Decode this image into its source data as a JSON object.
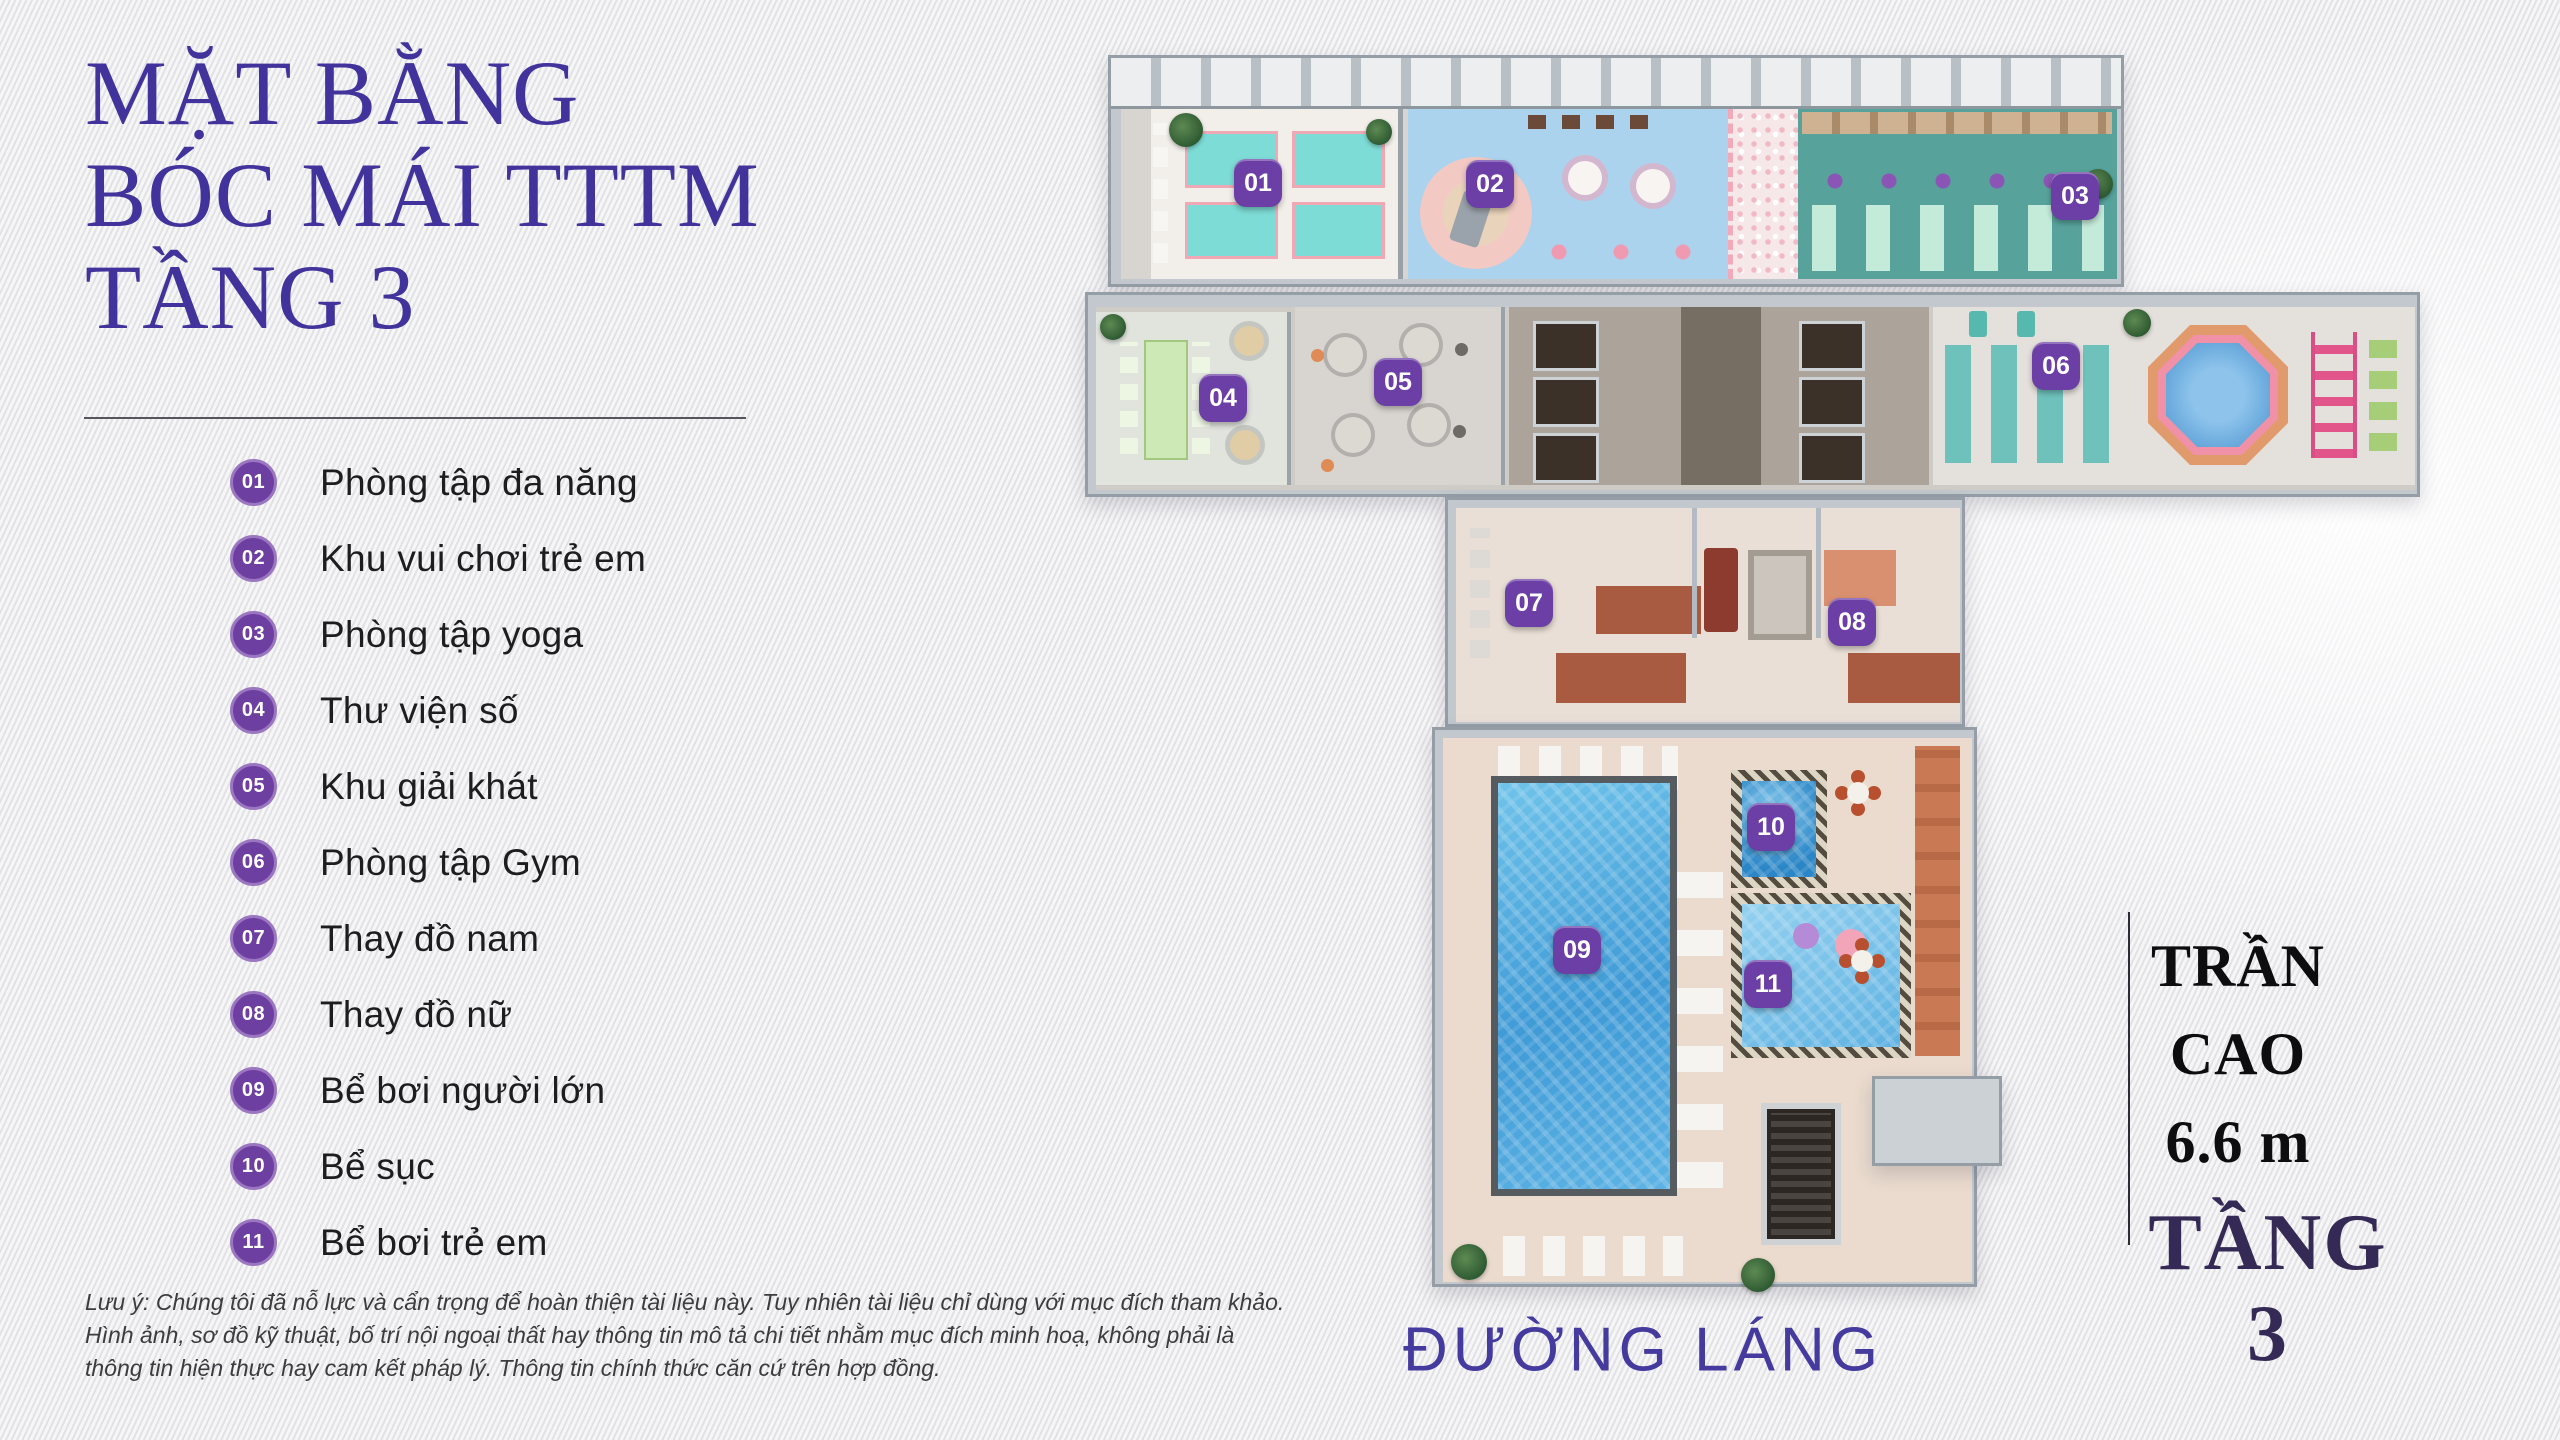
{
  "page": {
    "title_lines": [
      "MẶT BẰNG",
      "BÓC MÁI TTTM",
      "TẦNG 3"
    ]
  },
  "legend": {
    "items": [
      {
        "num": "01",
        "label": "Phòng tập đa năng"
      },
      {
        "num": "02",
        "label": "Khu vui chơi trẻ em"
      },
      {
        "num": "03",
        "label": "Phòng tập yoga"
      },
      {
        "num": "04",
        "label": "Thư viện số"
      },
      {
        "num": "05",
        "label": "Khu giải khát"
      },
      {
        "num": "06",
        "label": "Phòng tập Gym"
      },
      {
        "num": "07",
        "label": "Thay đồ nam"
      },
      {
        "num": "08",
        "label": "Thay đồ nữ"
      },
      {
        "num": "09",
        "label": "Bể bơi người lớn"
      },
      {
        "num": "10",
        "label": "Bể sục"
      },
      {
        "num": "11",
        "label": "Bể bơi trẻ em"
      }
    ]
  },
  "plan": {
    "badges": [
      "01",
      "02",
      "03",
      "04",
      "05",
      "06",
      "07",
      "08",
      "09",
      "10",
      "11"
    ],
    "street_label": "ĐƯỜNG LÁNG"
  },
  "annotation": {
    "ceiling_lines": [
      "TRẦN",
      "CAO",
      "6.6 m"
    ],
    "floor_label": "TẦNG 3"
  },
  "disclaimer": {
    "lines": [
      "Lưu ý: Chúng tôi đã nỗ lực và cẩn trọng để hoàn thiện tài liệu này. Tuy nhiên tài liệu chỉ dùng với mục đích tham khảo.",
      "Hình ảnh, sơ đồ kỹ thuật, bố trí nội ngoại thất hay thông tin mô tả chi tiết nhằm mục đích minh hoạ, không phải là",
      "thông tin hiện thực hay cam kết pháp lý. Thông tin chính thức căn cứ trên hợp đồng."
    ]
  },
  "colors": {
    "title_purple": "#41339b",
    "badge_purple": "#6b3fa5",
    "legend_badge_purple": "#6d3fa0",
    "street_label_purple": "#453a9e",
    "floor_label_dark": "#342a55",
    "pool_water_blue": "#3f9ad6",
    "yoga_room_teal": "#57a39c",
    "kids_room_blue": "#acd3ee"
  }
}
